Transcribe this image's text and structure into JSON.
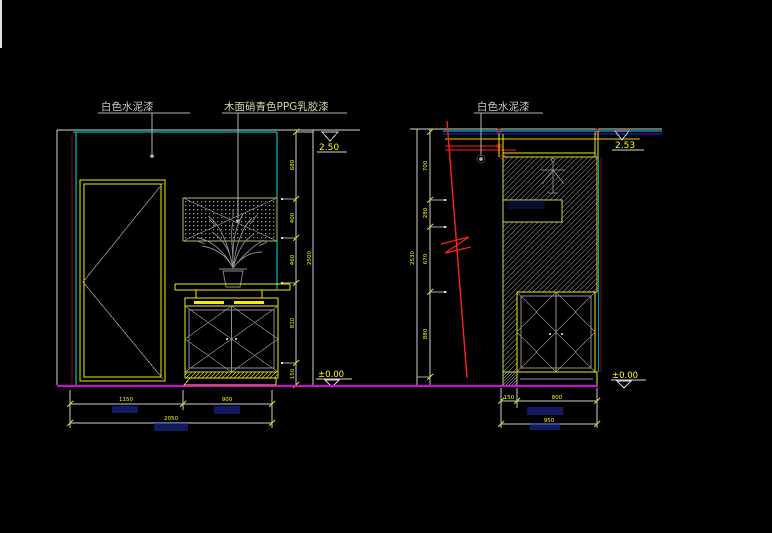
{
  "colors": {
    "background": "#000000",
    "line_primary": "#d9d9d9",
    "wall_cyan": "#00e5e5",
    "furniture_yellow": "#f0f000",
    "baseline_magenta": "#ff00ff",
    "section_red": "#ff2020",
    "ceiling_blue": "#2323ff",
    "dim_text_yellow": "#ffff00",
    "hatch_gray": "#8f8f8f"
  },
  "left": {
    "paint_label_wall": "白色水泥漆",
    "paint_label_panel": "木面硝青色PPG乳胶漆",
    "level_top": "2.50",
    "level_floor": "±0.00",
    "dims_vertical": [
      "680",
      "400",
      "460",
      "810",
      "150"
    ],
    "dim_vertical_total": "2500",
    "dims_bottom": [
      "1150",
      "900"
    ],
    "dim_bottom_total": "2050"
  },
  "right": {
    "paint_label_wall": "白色水泥漆",
    "level_top": "2.53",
    "level_floor": "±0.00",
    "dims_vertical": [
      "700",
      "280",
      "670",
      "880"
    ],
    "dim_vertical_total": "2530",
    "dims_bottom": [
      "150",
      "800"
    ],
    "dim_bottom_total": "950"
  }
}
